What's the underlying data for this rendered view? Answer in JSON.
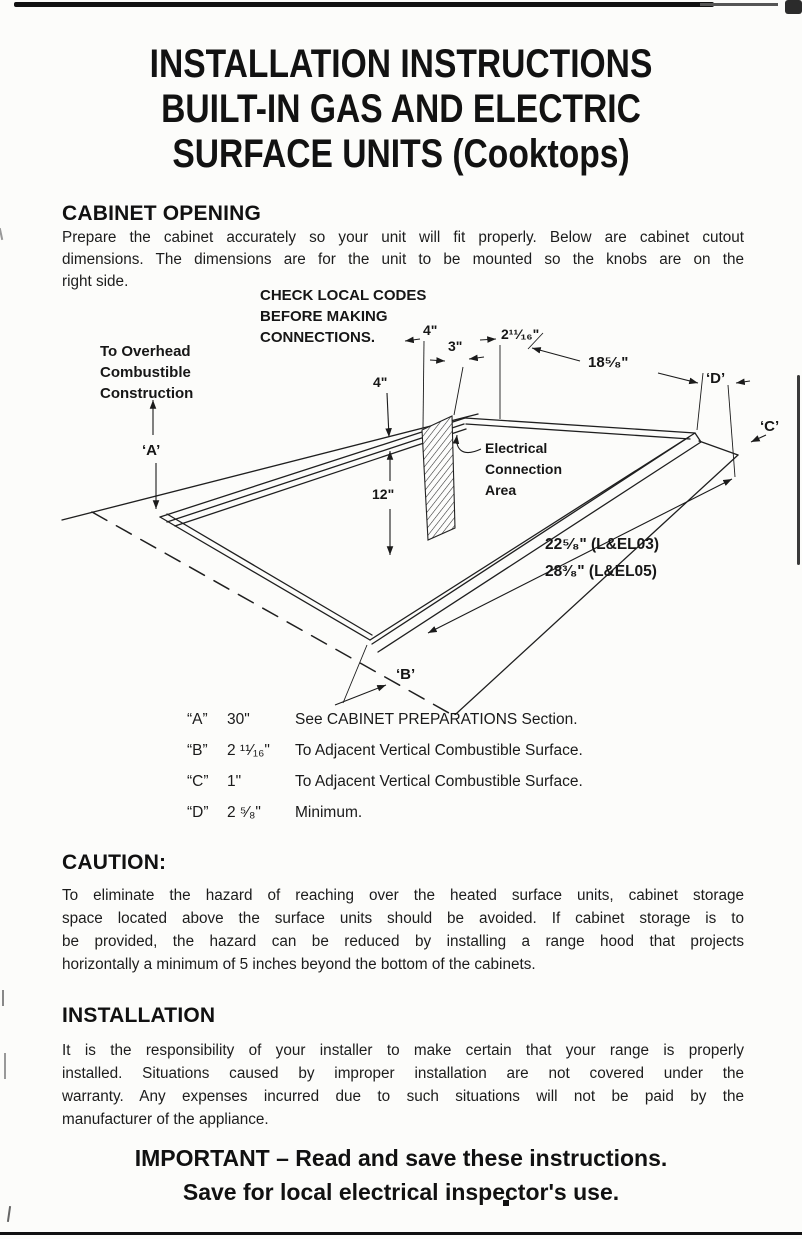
{
  "page": {
    "title_lines": [
      "INSTALLATION INSTRUCTIONS",
      "BUILT-IN GAS AND ELECTRIC",
      "SURFACE UNITS (Cooktops)"
    ]
  },
  "sections": {
    "cabinet_opening": {
      "heading": "CABINET OPENING",
      "lines": [
        "Prepare the cabinet accurately so your unit will fit properly. Below are cabinet cutout",
        "dimensions. The dimensions are for the unit to be mounted so the knobs are on the",
        "right side."
      ]
    },
    "caution": {
      "heading": "CAUTION:",
      "lines": [
        "To eliminate the hazard of reaching over the heated surface units, cabinet storage",
        "space located above the surface units should be avoided. If cabinet storage is to",
        "be provided, the hazard can be reduced by installing a range hood that projects",
        "horizontally a minimum of 5 inches beyond the bottom of the cabinets."
      ]
    },
    "installation": {
      "heading": "INSTALLATION",
      "lines": [
        "It is the responsibility of your installer to make certain that your range is properly",
        "installed. Situations caused by improper installation are not covered under the",
        "warranty. Any expenses incurred due to such situations will not be paid by the",
        "manufacturer of the appliance."
      ]
    },
    "footer": {
      "lines": [
        "IMPORTANT – Read and save these instructions.",
        "Save for local electrical inspector's use."
      ]
    }
  },
  "dimension_table": {
    "rows": [
      {
        "letter": "“A”",
        "value": "30\"",
        "description": "See CABINET PREPARATIONS Section."
      },
      {
        "letter": "“B”",
        "value": "2 ¹¹⁄₁₆\"",
        "description": "To Adjacent Vertical Combustible Surface."
      },
      {
        "letter": "“C”",
        "value": "1\"",
        "description": "To Adjacent Vertical Combustible Surface."
      },
      {
        "letter": "“D”",
        "value": "2 ⁵⁄₈\"",
        "description": "Minimum."
      }
    ]
  },
  "diagram": {
    "check_codes": [
      "CHECK LOCAL CODES",
      "BEFORE MAKING",
      "CONNECTIONS."
    ],
    "overhead": [
      "To Overhead",
      "Combustible",
      "Construction"
    ],
    "electrical": [
      "Electrical",
      "Connection",
      "Area"
    ],
    "dims": {
      "top_4": "4\"",
      "top_3": "3\"",
      "top_2_11_16": "2¹¹⁄₁₆\"",
      "top_18_5_8": "18⁵⁄₈\"",
      "left_4": "4\"",
      "inner_12": "12\"",
      "a": "‘A’",
      "b": "‘B’",
      "c": "‘C’",
      "d": "‘D’",
      "width_el03": "22⁵⁄₈\" (L&EL03)",
      "width_el05": "28³⁄₈\" (L&EL05)"
    }
  }
}
